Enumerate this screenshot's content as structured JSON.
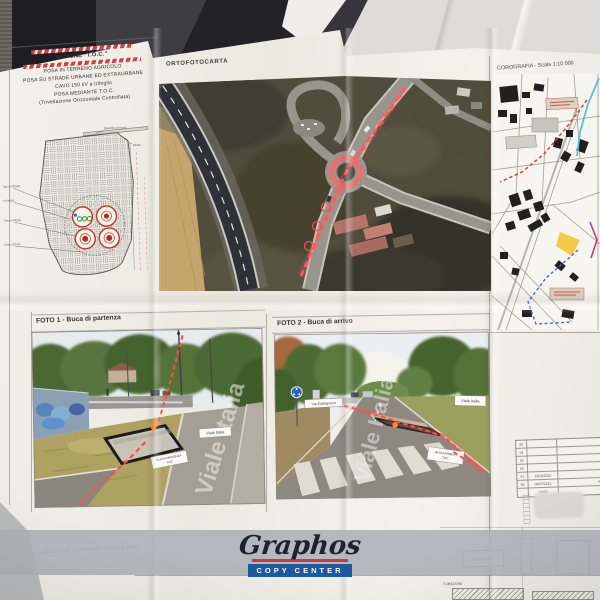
{
  "colors": {
    "paper": "#f1eee7",
    "annotation_red": "#ff4d52",
    "logo_blue": "#1d5a9e",
    "logo_red": "#cf3a31",
    "band_gray": "#adb2b9"
  },
  "sezione": {
    "title": "SEZIONE \"T.O.C.\"",
    "line1": "POSA IN TERRENO AGRICOLO",
    "line2": "POSA SU STRADE URBANE ED EXTRAURBANE",
    "line3": "CAVO 150 kV a trifoglio",
    "line4": "POSA MEDIANTE T.O.C.",
    "line5": "(Trivellazione Orizzontale Controllata)",
    "diagram": {
      "label_top1": "Tappetino di usura",
      "label_top2": "Binder",
      "label1": "Tubo in PEAD",
      "label2": "n.4 tritubi",
      "label3": "Tubo in PEAD",
      "label4": "Cavo 150 kV"
    }
  },
  "ortofoto": {
    "title": "ORTOFOTOCARTA"
  },
  "corografia": {
    "title": "COROGRAFIA - Scala 1:10 000"
  },
  "foto1": {
    "title": "FOTO 1 - Buca di partenza",
    "street_box": "Viale Italia",
    "pit_line1": "BUCA PARTENZA",
    "pit_line2": "TOC",
    "road_text": "Viale Italia"
  },
  "foto2": {
    "title": "FOTO 2 - Buca di arrivo",
    "cross_street_box": "Via Caltagirone",
    "street_box": "Viale Italia",
    "pit_line1": "BUCA ARRIVO",
    "pit_line2": "TOC",
    "road_text": "Viale Italia"
  },
  "layout": {
    "title": "LAYOUT DI CANTIERE - PIANTA TIPO",
    "deposito": "DEPOSITO",
    "tubazioni": "TUBAZIONI"
  },
  "revision_table": {
    "rows": [
      {
        "rev": "05",
        "date": "",
        "desc": ""
      },
      {
        "rev": "04",
        "date": "",
        "desc": ""
      },
      {
        "rev": "03",
        "date": "",
        "desc": ""
      },
      {
        "rev": "02",
        "date": "",
        "desc": ""
      },
      {
        "rev": "01",
        "date": "14/10/2022",
        "desc": "Aggiornamento"
      },
      {
        "rev": "00",
        "date": "09/07/2021",
        "desc": "Prima emissione"
      }
    ],
    "footer_label": "DATA"
  },
  "watermark": {
    "brand": "Graphos",
    "sub": "COPY CENTER"
  }
}
